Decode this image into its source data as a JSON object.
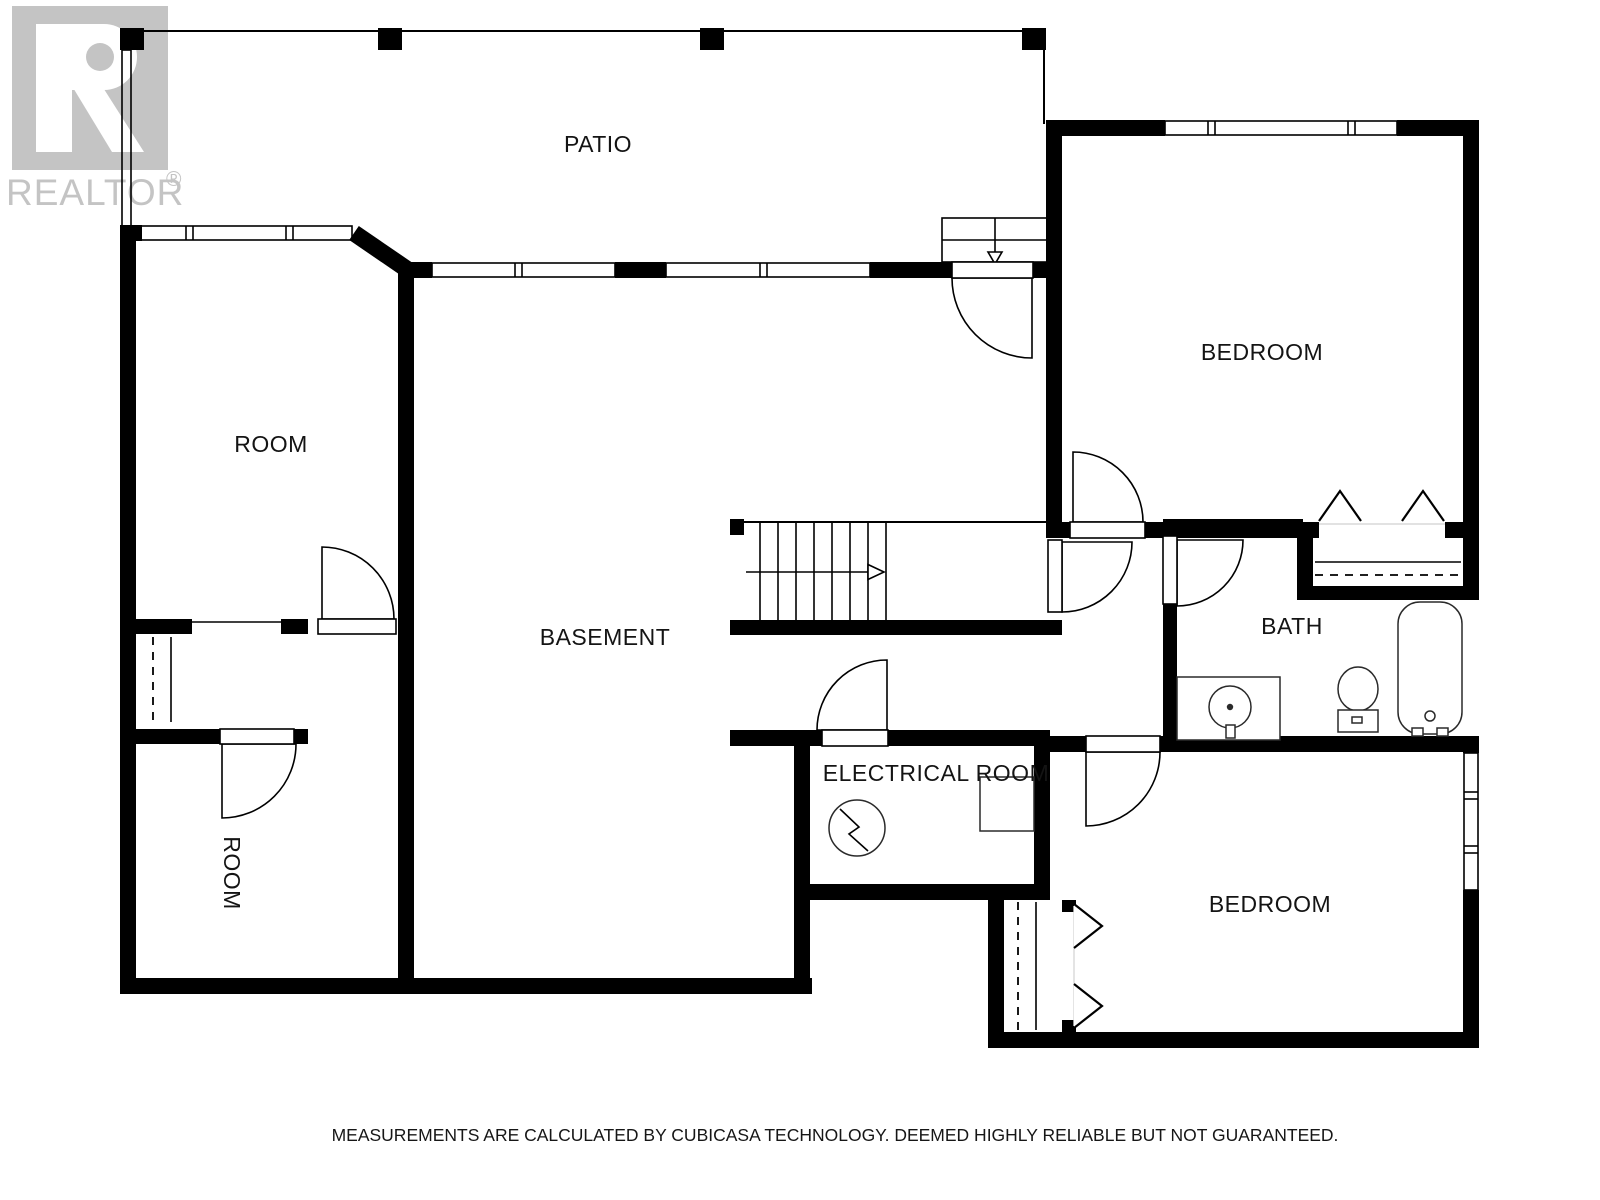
{
  "header": {
    "logo": {
      "brand": "REALTOR",
      "registered": "®"
    }
  },
  "rooms": {
    "patio": "PATIO",
    "room_upper": "ROOM",
    "bedroom_top": "BEDROOM",
    "basement": "BASEMENT",
    "bath": "BATH",
    "electrical": "ELECTRICAL ROOM",
    "room_lower": "ROOM",
    "bedroom_bottom": "BEDROOM"
  },
  "footer": {
    "disclaimer": "MEASUREMENTS ARE CALCULATED BY CUBICASA TECHNOLOGY. DEEMED HIGHLY RELIABLE BUT NOT GUARANTEED."
  },
  "colors": {
    "wall": "#000000",
    "background": "#ffffff",
    "logo_gray": "#c4c4c4"
  },
  "icons": {
    "realtor_logo": "gray-block-R",
    "stairs_direction_arrow": "right-arrow",
    "patio_steps_arrow": "down-arrow",
    "electrical_panel": "circle-with-lightning",
    "bifold_closet_door": "chevron",
    "sink": "circle-in-counter",
    "toilet": "oval-with-tank",
    "bathtub": "rounded-rectangle"
  }
}
